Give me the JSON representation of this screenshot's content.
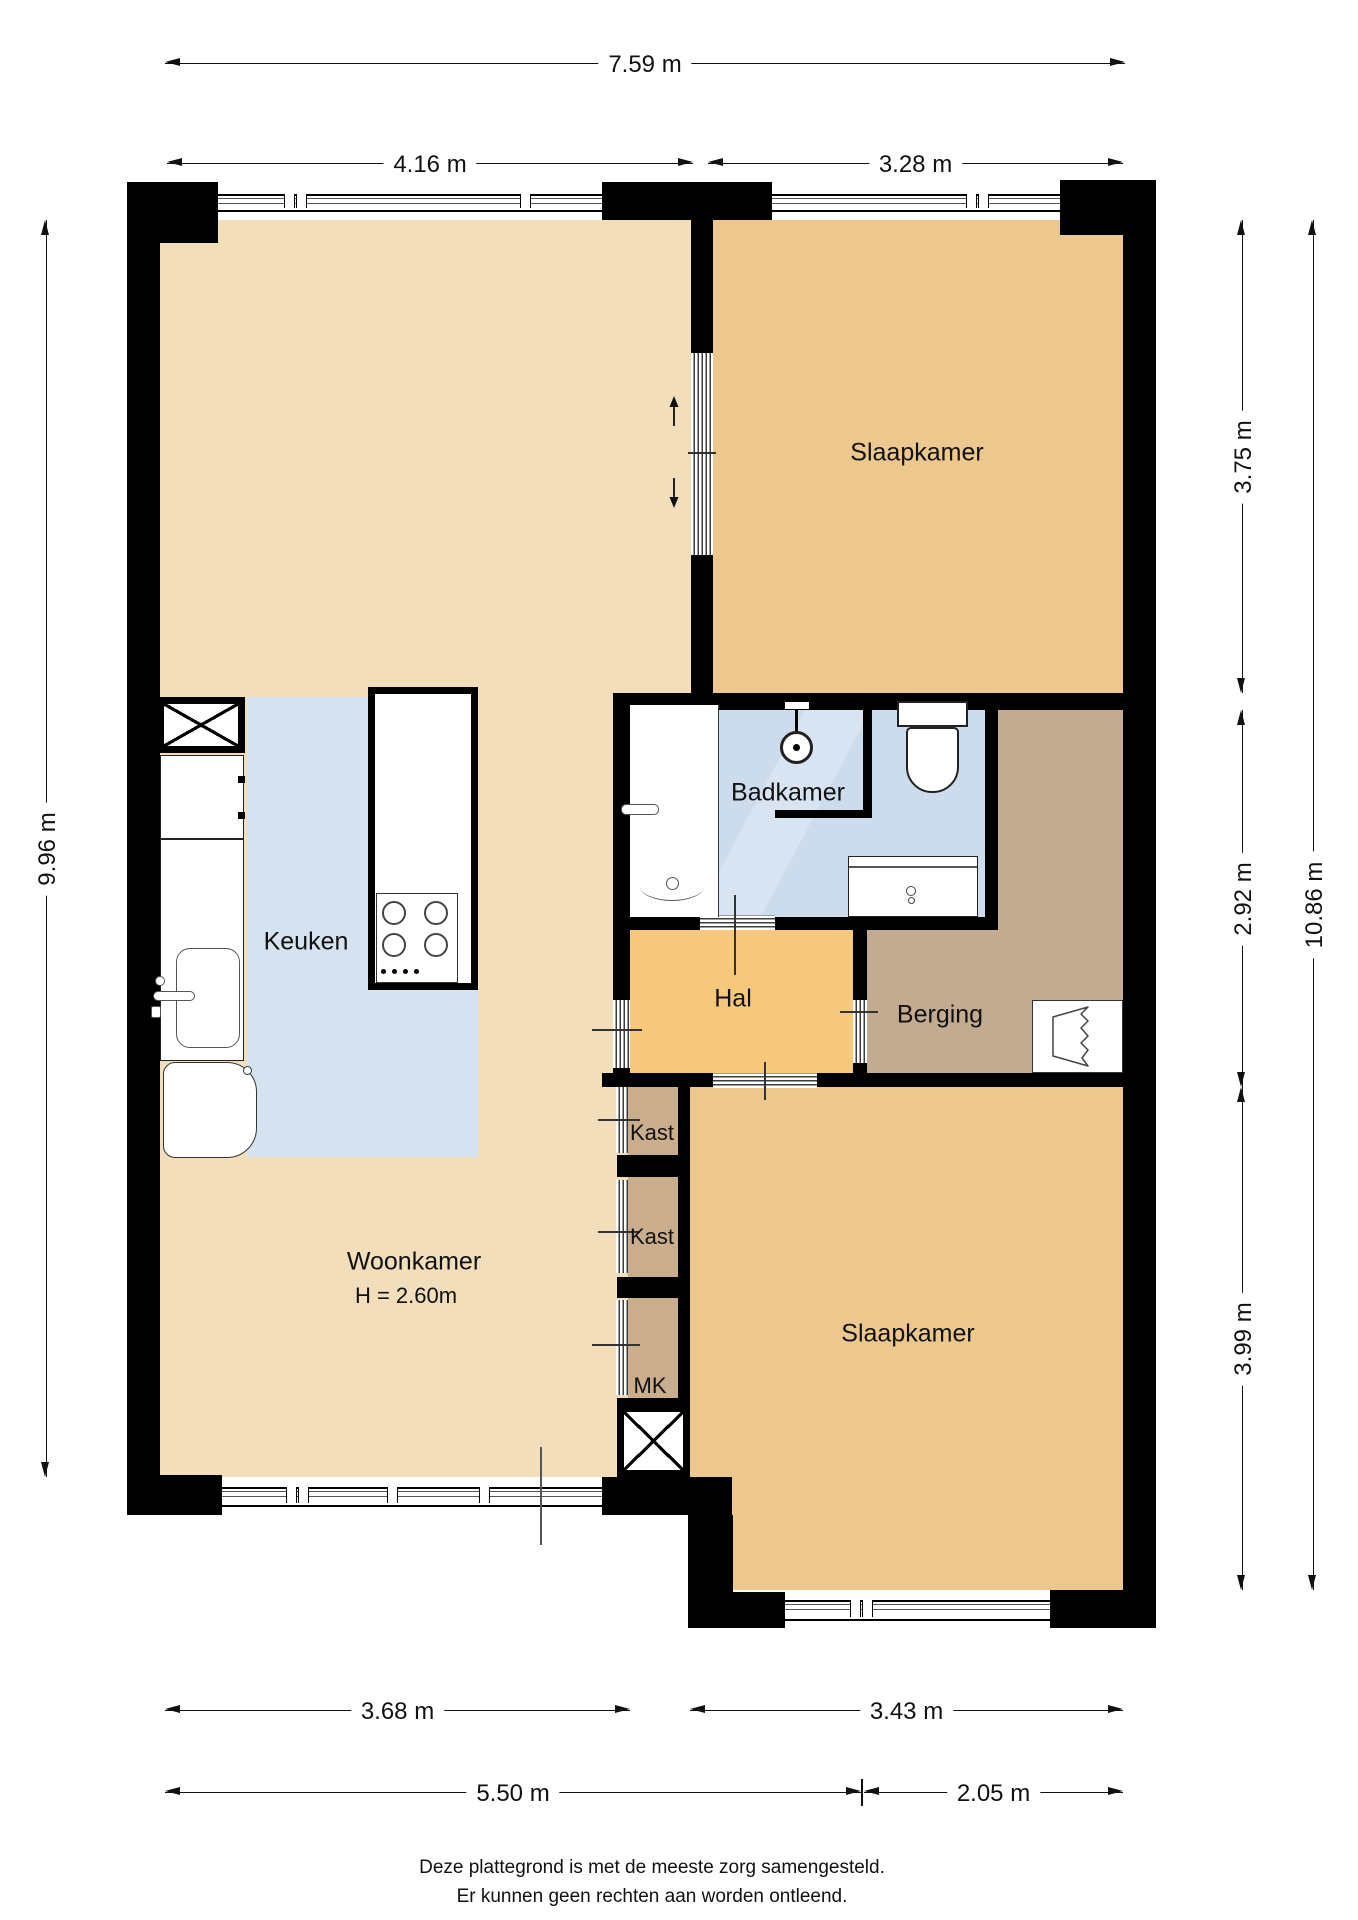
{
  "rooms": {
    "slaapkamer1": {
      "label": "Slaapkamer"
    },
    "slaapkamer2": {
      "label": "Slaapkamer"
    },
    "badkamer": {
      "label": "Badkamer"
    },
    "keuken": {
      "label": "Keuken"
    },
    "hal": {
      "label": "Hal"
    },
    "berging": {
      "label": "Berging"
    },
    "woonkamer": {
      "label": "Woonkamer",
      "height_note": "H = 2.60m"
    },
    "kast1": {
      "label": "Kast"
    },
    "kast2": {
      "label": "Kast"
    },
    "mk": {
      "label": "MK"
    }
  },
  "dimensions": {
    "top_total": "7.59 m",
    "top_left": "4.16 m",
    "top_right": "3.28 m",
    "side_left": "9.96 m",
    "right_top": "3.75 m",
    "right_middle": "2.92 m",
    "right_bottom": "3.99 m",
    "right_total": "10.86 m",
    "bottom_left": "3.68 m",
    "bottom_right": "3.43 m",
    "bottom_total_left": "5.50 m",
    "bottom_total_right": "2.05 m"
  },
  "footer": {
    "line1": "Deze plattegrond is met de meeste zorg samengesteld.",
    "line2": "Er kunnen geen rechten aan worden ontleend."
  },
  "colors": {
    "wall": "#000000",
    "woonkamer_floor": "#f2deba",
    "slaapkamer_floor": "#ecc88e",
    "hal_floor": "#f6c87c",
    "berging_floor": "#c3ab92",
    "kast_floor": "#c9ad8d",
    "badkamer_floor": "#ccdcec",
    "keuken_floor": "#d5e2f0"
  }
}
